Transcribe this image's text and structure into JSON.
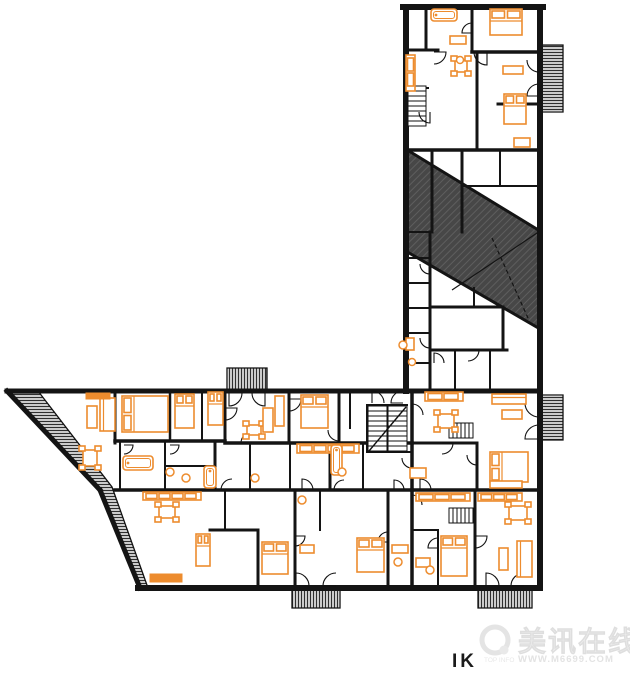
{
  "canvas": {
    "w": 630,
    "h": 673,
    "background": "#ffffff"
  },
  "colors": {
    "wall": "#141414",
    "outline": "#111111",
    "furniture": "#ED8C2E",
    "roof_fill": "#474747",
    "roof_line": "#5e5e5e",
    "hatch_line": "#2f2f2f",
    "watermark": "#ededed",
    "watermark_dim": "#e2e2e2",
    "caption": "#1a1a1a"
  },
  "watermark": {
    "title": "美讯在线",
    "subtitle": "WWW.M6699.COM",
    "prefix": "TOP INFO"
  },
  "caption": {
    "text": "IK"
  },
  "plan": {
    "hatches": [
      {
        "name": "roof-terrace",
        "pattern": "roof",
        "points": [
          [
            404,
            148
          ],
          [
            540,
            231
          ],
          [
            540,
            329
          ],
          [
            404,
            250
          ]
        ]
      },
      {
        "name": "balcony-right-top",
        "pattern": "h",
        "points": [
          [
            541,
            45
          ],
          [
            563,
            45
          ],
          [
            563,
            112
          ],
          [
            541,
            112
          ]
        ]
      },
      {
        "name": "balcony-right-mid",
        "pattern": "h",
        "points": [
          [
            541,
            395
          ],
          [
            563,
            395
          ],
          [
            563,
            440
          ],
          [
            541,
            440
          ]
        ]
      },
      {
        "name": "balcony-top",
        "pattern": "v",
        "points": [
          [
            227,
            368
          ],
          [
            267,
            368
          ],
          [
            267,
            391
          ],
          [
            227,
            391
          ]
        ]
      },
      {
        "name": "balcony-bottom-1",
        "pattern": "v",
        "points": [
          [
            292,
            588
          ],
          [
            340,
            588
          ],
          [
            340,
            608
          ],
          [
            292,
            608
          ]
        ]
      },
      {
        "name": "balcony-bottom-2",
        "pattern": "v",
        "points": [
          [
            478,
            588
          ],
          [
            532,
            588
          ],
          [
            532,
            608
          ],
          [
            478,
            608
          ]
        ]
      },
      {
        "name": "terrace-wedge",
        "pattern": "h",
        "points": [
          [
            7,
            391
          ],
          [
            38,
            391
          ],
          [
            112,
            487
          ],
          [
            148,
            588
          ],
          [
            140,
            588
          ],
          [
            100,
            490
          ]
        ]
      }
    ],
    "walls": [
      [
        403,
        7,
        543,
        7,
        6
      ],
      [
        540,
        7,
        540,
        588,
        6
      ],
      [
        406,
        7,
        406,
        391,
        6
      ],
      [
        7,
        391,
        540,
        391,
        5
      ],
      [
        138,
        588,
        540,
        588,
        6
      ],
      [
        7,
        391,
        100,
        490,
        5
      ],
      [
        100,
        490,
        140,
        588,
        5
      ],
      [
        426,
        7,
        426,
        50,
        3
      ],
      [
        406,
        50,
        438,
        50,
        3
      ],
      [
        472,
        7,
        472,
        52,
        3
      ],
      [
        472,
        52,
        540,
        52,
        3.5
      ],
      [
        406,
        88,
        428,
        88,
        2
      ],
      [
        477,
        52,
        477,
        150,
        3
      ],
      [
        406,
        150,
        540,
        150,
        3.5
      ],
      [
        498,
        104,
        540,
        104,
        3
      ],
      [
        432,
        150,
        432,
        232,
        3
      ],
      [
        462,
        150,
        462,
        232,
        3
      ],
      [
        462,
        186,
        540,
        186,
        2
      ],
      [
        500,
        150,
        500,
        186,
        2
      ],
      [
        430,
        232,
        430,
        391,
        3
      ],
      [
        406,
        232,
        430,
        232,
        2
      ],
      [
        406,
        258,
        430,
        258,
        2
      ],
      [
        406,
        283,
        430,
        283,
        2
      ],
      [
        406,
        308,
        430,
        308,
        2
      ],
      [
        406,
        333,
        430,
        333,
        2
      ],
      [
        406,
        363,
        430,
        363,
        2
      ],
      [
        430,
        307,
        500,
        307,
        3
      ],
      [
        503,
        307,
        503,
        350,
        3
      ],
      [
        430,
        350,
        507,
        350,
        3
      ],
      [
        474,
        288,
        474,
        307,
        2
      ],
      [
        455,
        350,
        455,
        391,
        2
      ],
      [
        490,
        350,
        490,
        391,
        2
      ],
      [
        115,
        391,
        115,
        443,
        3
      ],
      [
        115,
        441,
        225,
        441,
        3.5
      ],
      [
        170,
        391,
        170,
        441,
        2.5
      ],
      [
        202,
        391,
        202,
        441,
        2
      ],
      [
        225,
        391,
        225,
        443,
        3
      ],
      [
        289,
        391,
        289,
        443,
        3
      ],
      [
        339,
        391,
        339,
        443,
        3
      ],
      [
        225,
        443,
        412,
        443,
        3.5
      ],
      [
        350,
        391,
        350,
        428,
        2
      ],
      [
        367,
        405,
        407,
        405,
        2
      ],
      [
        367,
        405,
        367,
        452,
        2
      ],
      [
        367,
        452,
        412,
        452,
        2
      ],
      [
        412,
        391,
        412,
        588,
        3.5
      ],
      [
        412,
        443,
        477,
        443,
        3
      ],
      [
        477,
        443,
        477,
        490,
        3
      ],
      [
        412,
        490,
        540,
        490,
        3.5
      ],
      [
        115,
        490,
        412,
        490,
        3.5
      ],
      [
        120,
        443,
        120,
        490,
        2
      ],
      [
        165,
        443,
        165,
        490,
        2
      ],
      [
        215,
        443,
        215,
        490,
        3
      ],
      [
        165,
        466,
        215,
        466,
        2
      ],
      [
        250,
        443,
        250,
        490,
        2
      ],
      [
        290,
        443,
        290,
        490,
        2
      ],
      [
        330,
        443,
        330,
        490,
        3
      ],
      [
        363,
        443,
        363,
        490,
        2
      ],
      [
        210,
        530,
        258,
        530,
        3
      ],
      [
        258,
        530,
        258,
        588,
        3
      ],
      [
        225,
        490,
        225,
        530,
        2
      ],
      [
        295,
        490,
        295,
        588,
        3
      ],
      [
        320,
        490,
        320,
        530,
        2
      ],
      [
        388,
        490,
        388,
        588,
        3
      ],
      [
        475,
        490,
        475,
        588,
        3
      ],
      [
        438,
        530,
        438,
        588,
        2
      ],
      [
        412,
        530,
        438,
        530,
        2
      ]
    ],
    "lines": [
      {
        "p": [
          404,
          148,
          540,
          231
        ],
        "t": 3,
        "dash": ""
      },
      {
        "p": [
          404,
          250,
          540,
          329
        ],
        "t": 3,
        "dash": ""
      },
      {
        "p": [
          452,
          290,
          540,
          231
        ],
        "t": 1.2,
        "dash": ""
      },
      {
        "p": [
          492,
          238,
          528,
          318
        ],
        "t": 1.2,
        "dash": "4 3"
      }
    ],
    "doors": [
      [
        229,
        393,
        13,
        90,
        0
      ],
      [
        265,
        393,
        13,
        90,
        180
      ],
      [
        296,
        586,
        13,
        -90,
        0
      ],
      [
        336,
        586,
        13,
        180,
        270
      ],
      [
        486,
        586,
        13,
        -90,
        0
      ],
      [
        524,
        586,
        13,
        180,
        270
      ],
      [
        539,
        403,
        14,
        90,
        180
      ],
      [
        539,
        439,
        14,
        180,
        270
      ],
      [
        539,
        60,
        12,
        90,
        180
      ],
      [
        539,
        96,
        12,
        180,
        270
      ],
      [
        372,
        403,
        12,
        -90,
        0
      ],
      [
        403,
        403,
        12,
        180,
        -90
      ],
      [
        434,
        52,
        12,
        0,
        90
      ],
      [
        487,
        52,
        13,
        90,
        180
      ],
      [
        430,
        264,
        10,
        90,
        180
      ],
      [
        430,
        338,
        10,
        90,
        180
      ],
      [
        468,
        350,
        11,
        0,
        90
      ],
      [
        289,
        399,
        12,
        0,
        90
      ],
      [
        339,
        430,
        11,
        90,
        180
      ],
      [
        225,
        408,
        12,
        0,
        90
      ],
      [
        252,
        443,
        11,
        180,
        270
      ],
      [
        124,
        445,
        9,
        0,
        90
      ],
      [
        170,
        445,
        9,
        0,
        90
      ],
      [
        232,
        490,
        11,
        180,
        270
      ],
      [
        302,
        490,
        11,
        -90,
        0
      ],
      [
        344,
        490,
        10,
        180,
        270
      ],
      [
        394,
        490,
        10,
        -90,
        0
      ],
      [
        420,
        490,
        11,
        -90,
        0
      ],
      [
        505,
        490,
        12,
        -90,
        0
      ],
      [
        475,
        536,
        12,
        0,
        90
      ],
      [
        412,
        415,
        11,
        -90,
        0
      ],
      [
        412,
        458,
        10,
        90,
        180
      ],
      [
        412,
        505,
        10,
        -90,
        0
      ],
      [
        442,
        443,
        11,
        0,
        90
      ],
      [
        477,
        455,
        10,
        90,
        180
      ],
      [
        430,
        112,
        11,
        90,
        180
      ],
      [
        472,
        33,
        10,
        180,
        270
      ],
      [
        434,
        363,
        10,
        -90,
        0
      ],
      [
        295,
        536,
        10,
        0,
        90
      ],
      [
        388,
        542,
        10,
        180,
        270
      ],
      [
        438,
        548,
        10,
        180,
        270
      ]
    ],
    "stairs": [
      {
        "x": 408,
        "y": 86,
        "w": 18,
        "h": 40,
        "dir": "h",
        "step": 5,
        "mid": 0,
        "diag": 0
      },
      {
        "x": 368,
        "y": 406,
        "w": 39,
        "h": 46,
        "dir": "h",
        "step": 5,
        "mid": 1,
        "diag": 1
      },
      {
        "x": 449,
        "y": 423,
        "w": 24,
        "h": 15,
        "dir": "v",
        "step": 4,
        "mid": 0,
        "diag": 0
      },
      {
        "x": 449,
        "y": 508,
        "w": 24,
        "h": 15,
        "dir": "v",
        "step": 4,
        "mid": 0,
        "diag": 0
      }
    ],
    "furniture": [
      [
        "bed",
        490,
        9,
        32,
        26,
        "t"
      ],
      [
        "bed",
        504,
        94,
        22,
        30,
        "t"
      ],
      [
        "bed",
        122,
        396,
        46,
        36,
        "l"
      ],
      [
        "bed",
        175,
        394,
        19,
        34,
        "t"
      ],
      [
        "bed",
        208,
        392,
        15,
        33,
        "t"
      ],
      [
        "bed",
        301,
        395,
        27,
        33,
        "t"
      ],
      [
        "bed",
        490,
        452,
        38,
        30,
        "l"
      ],
      [
        "bed",
        262,
        542,
        26,
        32,
        "t"
      ],
      [
        "bed",
        196,
        534,
        14,
        32,
        "t"
      ],
      [
        "bed",
        357,
        538,
        27,
        34,
        "t"
      ],
      [
        "bed",
        441,
        536,
        26,
        40,
        "t"
      ],
      [
        "table",
        451,
        56,
        20,
        20,
        ""
      ],
      [
        "table",
        79,
        446,
        22,
        24,
        ""
      ],
      [
        "table",
        243,
        421,
        22,
        18,
        ""
      ],
      [
        "table",
        434,
        410,
        24,
        22,
        ""
      ],
      [
        "table",
        155,
        502,
        24,
        20,
        ""
      ],
      [
        "table",
        505,
        502,
        26,
        22,
        ""
      ],
      [
        "sofa",
        100,
        398,
        15,
        33,
        ""
      ],
      [
        "sofa",
        492,
        394,
        34,
        10,
        ""
      ],
      [
        "sofa",
        517,
        541,
        15,
        36,
        ""
      ],
      [
        "box",
        87,
        406,
        10,
        22,
        ""
      ],
      [
        "box",
        263,
        408,
        10,
        24,
        ""
      ],
      [
        "box",
        502,
        410,
        20,
        9,
        ""
      ],
      [
        "box",
        499,
        548,
        9,
        22,
        ""
      ],
      [
        "box",
        450,
        36,
        16,
        8,
        ""
      ],
      [
        "box",
        514,
        138,
        16,
        9,
        ""
      ],
      [
        "box",
        503,
        66,
        20,
        8,
        ""
      ],
      [
        "box",
        410,
        468,
        16,
        10,
        ""
      ],
      [
        "box",
        416,
        558,
        14,
        9,
        ""
      ],
      [
        "box",
        275,
        396,
        9,
        30,
        ""
      ],
      [
        "box",
        490,
        481,
        32,
        7,
        ""
      ],
      [
        "box",
        300,
        545,
        14,
        8,
        ""
      ],
      [
        "box",
        392,
        545,
        16,
        8,
        ""
      ],
      [
        "box",
        406,
        338,
        8,
        12,
        ""
      ],
      [
        "bar",
        86,
        393,
        24,
        6,
        ""
      ],
      [
        "bar",
        150,
        574,
        32,
        8,
        ""
      ],
      [
        "counter",
        406,
        55,
        9,
        36,
        ""
      ],
      [
        "counter",
        425,
        392,
        38,
        9,
        ""
      ],
      [
        "counter",
        297,
        444,
        62,
        9,
        ""
      ],
      [
        "counter",
        416,
        493,
        54,
        8,
        ""
      ],
      [
        "counter",
        478,
        493,
        44,
        8,
        ""
      ],
      [
        "counter",
        143,
        492,
        58,
        8,
        ""
      ],
      [
        "tub",
        431,
        9,
        26,
        12,
        ""
      ],
      [
        "tub",
        123,
        456,
        30,
        14,
        ""
      ],
      [
        "tub",
        204,
        466,
        12,
        22,
        ""
      ],
      [
        "tub",
        331,
        445,
        11,
        30,
        ""
      ],
      [
        "round",
        403,
        345,
        6,
        6,
        ""
      ],
      [
        "round",
        412,
        362,
        5,
        5,
        ""
      ],
      [
        "round",
        170,
        472,
        6,
        6,
        ""
      ],
      [
        "round",
        186,
        478,
        6,
        6,
        ""
      ],
      [
        "round",
        255,
        478,
        6,
        6,
        ""
      ],
      [
        "round",
        302,
        500,
        6,
        6,
        ""
      ],
      [
        "round",
        342,
        472,
        6,
        6,
        ""
      ],
      [
        "round",
        398,
        562,
        6,
        6,
        ""
      ],
      [
        "round",
        430,
        570,
        6,
        6,
        ""
      ],
      [
        "round",
        460,
        60,
        5,
        5,
        ""
      ]
    ]
  }
}
